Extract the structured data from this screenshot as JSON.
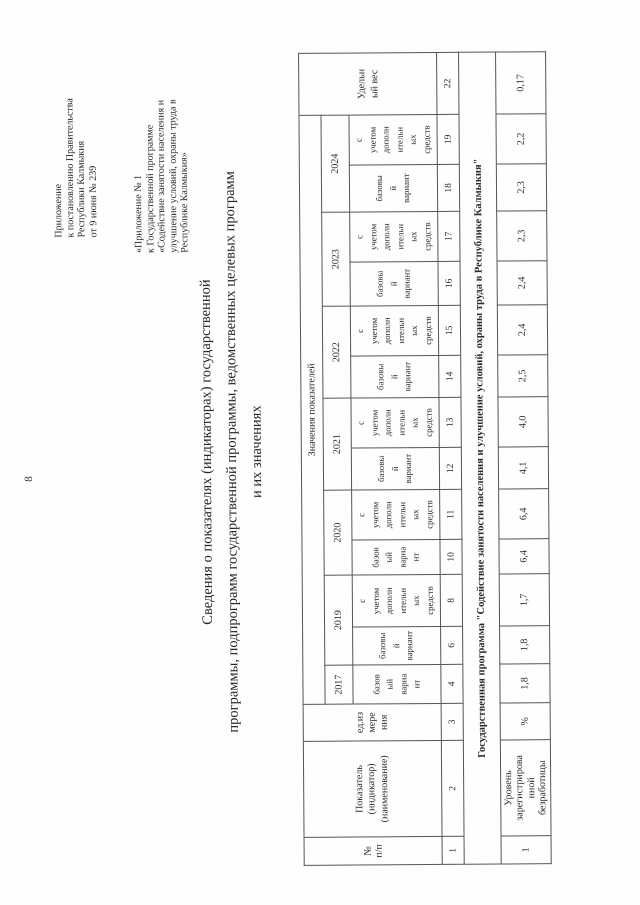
{
  "page_number": "8",
  "colors": {
    "ink": "#2b2b2b",
    "border": "#555555",
    "paper": "#fefefe"
  },
  "header_right": {
    "block1": "Приложение\nк постановлению Правительства\nРеспублики Калмыкия\nот 9 июня № 239",
    "block2": "«Приложение № 1\nк Государственной программе\n«Содействие занятости населения и\nулучшение условий, охраны труда в\nРеспублике Калмыкия»"
  },
  "title": "Сведения о показателях (индикаторах) государственной\nпрограммы, подпрограмм государственной программы, ведомственных целевых программ\nи их значениях",
  "table": {
    "header": {
      "col_num": "№\nп/п",
      "col_indicator": "Показатель\n(индикатор)\n(наименование)",
      "col_unit": "ед.из\nмере\nния",
      "values_title": "Значения показателей",
      "col_weight": "Удельн\nый вес",
      "years": [
        "2017",
        "2019",
        "2020",
        "2021",
        "2022",
        "2023",
        "2024"
      ],
      "variants": [
        "базов\nый\nвариа\nнт",
        "базовы\nй\nвариант",
        "с\nучетом\nдополн\nительн\nых\nсредств",
        "базов\nый\nвариа\nнт",
        "с\nучетом\nдополн\nительн\nых\nсредств",
        "базовы\nй\nвариант",
        "с\nучетом\nдополн\nительн\nых\nсредств",
        "базовы\nй\nвариант",
        "с\nучетом\nдополн\nительн\nых\nсредств",
        "базовы\nй\nвариант",
        "с\nучетом\nдополн\nительн\nых\nсредств",
        "базовы\nй\nвариант",
        "с\nучетом\nдополн\nительн\nых\nсредств"
      ],
      "column_numbers": [
        "1",
        "2",
        "3",
        "4",
        "6",
        "8",
        "10",
        "11",
        "12",
        "13",
        "14",
        "15",
        "16",
        "17",
        "18",
        "19",
        "22"
      ]
    },
    "section_row": "Государственная программа \"Содействие занятости населения и улучшение условий, охраны труда в Республике Калмыкия\"",
    "rows": [
      {
        "num": "1",
        "indicator": "Уровень\nзарегистрирова\nнной\nбезработицы",
        "unit": "%",
        "values": [
          "1,8",
          "1,8",
          "1,7",
          "6,4",
          "6,4",
          "4,1",
          "4,0",
          "2,5",
          "2,4",
          "2,4",
          "2,3",
          "2,3",
          "2,2",
          "0,17"
        ]
      }
    ]
  }
}
